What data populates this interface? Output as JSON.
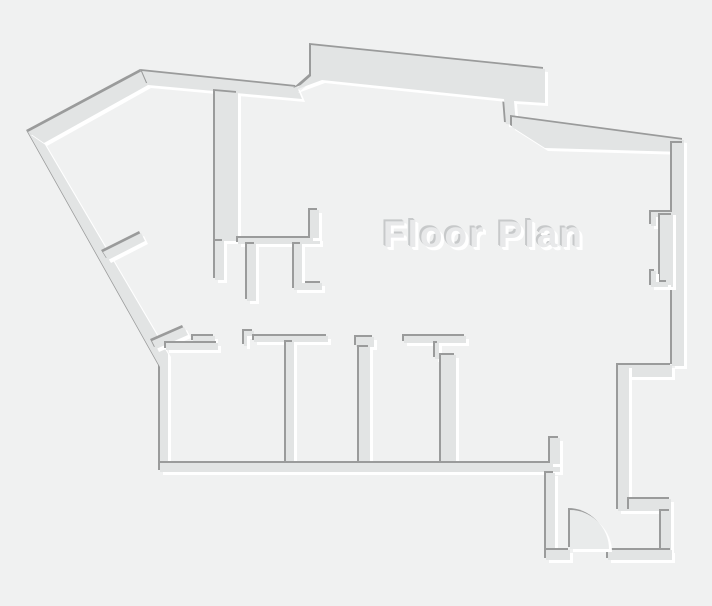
{
  "title": "Floor Plan",
  "canvas": {
    "width": 712,
    "height": 606
  },
  "colors": {
    "background": "#f0f1f1",
    "wall_fill": "#e2e4e4",
    "wall_shadow": "#9a9b9b",
    "wall_highlight": "#ffffff",
    "door_fill": "#e9ebeb",
    "title_fill": "#e8e9ea",
    "title_shadow": "#c7c9ca",
    "title_highlight": "#ffffff"
  },
  "emboss": {
    "shadow_dx": -2,
    "shadow_dy": -2,
    "highlight_dx": 3,
    "highlight_dy": 3
  },
  "title_pos": {
    "left": 383,
    "top": 214,
    "font_size": 37
  },
  "walls": [
    {
      "name": "outer-wall-west",
      "d": "M28,132 L160,367 L160,472 L168,472 L168,354 L44,143 Z"
    },
    {
      "name": "outer-wall-northwest",
      "d": "M28,132 L142,71 L148,85 L44,143 Z"
    },
    {
      "name": "outer-wall-north",
      "d": "M142,71 L297,87 L302,99 L148,85 Z"
    },
    {
      "name": "outer-wall-north-band",
      "d": "M311,45 L545,69 L545,103 L514,101 L516,125 L506,124 L504,99 L322,80 L295,90 L311,76 Z"
    },
    {
      "name": "outer-wall-northeast",
      "d": "M512,117 L684,140 L684,152 L545,148 L512,127 Z"
    },
    {
      "name": "outer-wall-east",
      "d": "M672,143 L684,143 L684,366 L672,366 Z"
    },
    {
      "name": "east-window-jamb-top",
      "d": "M651,212 L673,212 L673,217 L656,217 L656,226 L651,226 Z"
    },
    {
      "name": "east-window-band",
      "d": "M660,215 L673,215 L673,287 L660,287 Z"
    },
    {
      "name": "east-window-jamb-bottom",
      "d": "M651,271 L656,271 L656,282 L668,282 L668,287 L651,287 Z"
    },
    {
      "name": "east-notch-top-wall",
      "d": "M629,365 L672,365 L672,377 L629,377 Z"
    },
    {
      "name": "east-inner-wall",
      "d": "M618,365 L629,365 L629,511 L618,511 Z"
    },
    {
      "name": "east-notch-bottom-wall",
      "d": "M629,499 L671,499 L671,511 L629,511 Z"
    },
    {
      "name": "entry-east-wall",
      "d": "M661,511 L671,511 L671,551 L661,551 Z"
    },
    {
      "name": "core-west-wall",
      "d": "M215,91 L238,93 L238,241 L215,241 Z"
    },
    {
      "name": "core-west-wall-stub",
      "d": "M215,241 L224,241 L224,280 L215,280 Z"
    },
    {
      "name": "core-south-wall",
      "d": "M238,238 L320,238 L320,244 L238,244 Z"
    },
    {
      "name": "core-east-riser",
      "d": "M310,210 L319,210 L319,238 L310,238 Z"
    },
    {
      "name": "core-door-jamb-1",
      "d": "M247,244 L256,244 L256,301 L247,301 Z"
    },
    {
      "name": "core-door-jamb-2",
      "d": "M294,244 L302,244 L302,283 L322,283 L322,290 L294,290 Z"
    },
    {
      "name": "west-partition-stub-upper",
      "d": "M103,252 L141,233 L145,241 L108,260 Z"
    },
    {
      "name": "corridor-stub-wall",
      "d": "M193,336 L215,336 L215,342 L193,342 Z"
    },
    {
      "name": "west-partition-stub-lower",
      "d": "M152,341 L184,327 L188,335 L156,349 Z"
    },
    {
      "name": "room1-north-wall",
      "d": "M166,343 L218,343 L218,350 L166,350 Z"
    },
    {
      "name": "room1-door-jamb-step",
      "d": "M244,331 L254,331 L254,336 L247,336 L247,346 L244,346 Z"
    },
    {
      "name": "rooms-north-wall",
      "d": "M254,336 L328,336 L328,342 L254,342 Z"
    },
    {
      "name": "divider2-cap",
      "d": "M356,337 L374,337 L374,347 L356,347 Z"
    },
    {
      "name": "rooms-north-wall-east",
      "d": "M404,336 L466,336 L466,343 L404,343 Z"
    },
    {
      "name": "divider3-jamb",
      "d": "M435,343 L439,343 L439,359 L435,359 Z"
    },
    {
      "name": "room-divider-1",
      "d": "M286,342 L294,342 L294,466 L286,466 Z"
    },
    {
      "name": "room-divider-2",
      "d": "M359,347 L370,347 L370,466 L359,466 Z"
    },
    {
      "name": "room-divider-3",
      "d": "M441,355 L456,355 L456,466 L441,466 Z"
    },
    {
      "name": "outer-wall-south",
      "d": "M160,463 L560,463 L560,472 L160,472 Z"
    },
    {
      "name": "entry-north-stub",
      "d": "M550,438 L560,438 L560,464 L550,464 Z"
    },
    {
      "name": "entry-west-wall",
      "d": "M546,473 L555,473 L555,551 L546,551 Z"
    },
    {
      "name": "entry-south-wall-left",
      "d": "M546,550 L570,550 L570,560 L546,560 Z"
    },
    {
      "name": "entry-south-wall-right",
      "d": "M608,550 L672,550 L672,560 L608,560 Z"
    }
  ],
  "door": {
    "name": "entry-door-swing",
    "d": "M570,549 L570,510 A39,39 0 0 1 609,549 Z"
  }
}
